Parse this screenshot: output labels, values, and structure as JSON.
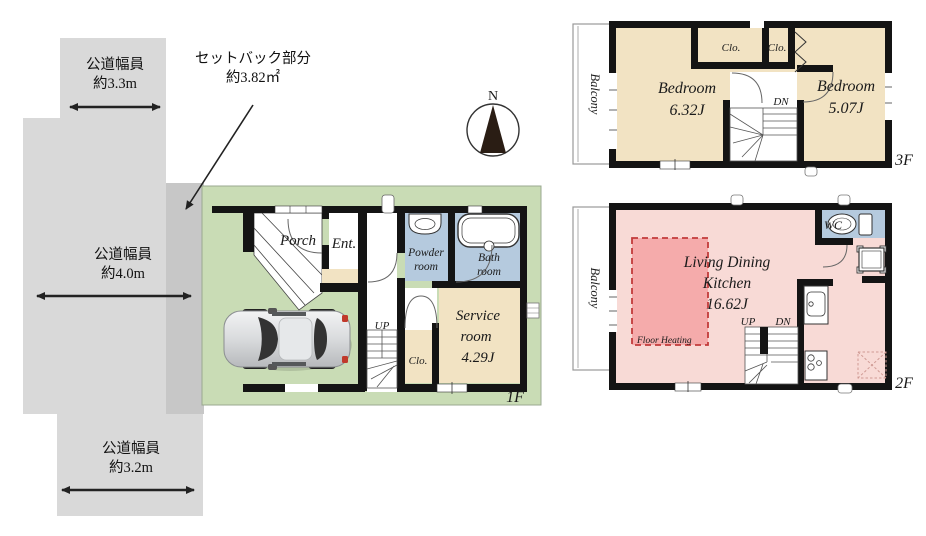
{
  "site_plan": {
    "roads": [
      {
        "label_line1": "公道幅員",
        "label_line2": "約3.3m"
      },
      {
        "label_line1": "公道幅員",
        "label_line2": "約4.0m"
      },
      {
        "label_line1": "公道幅員",
        "label_line2": "約3.2m"
      }
    ],
    "setback": {
      "label_line1": "セットバック部分",
      "label_line2": "約3.82㎡"
    }
  },
  "compass": {
    "north": "N"
  },
  "floors": {
    "f1": {
      "label": "1F",
      "porch": "Porch",
      "entrance": "Ent.",
      "powder_line1": "Powder",
      "powder_line2": "room",
      "bath_line1": "Bath",
      "bath_line2": "room",
      "service_line1": "Service",
      "service_line2": "room",
      "service_line3": "4.29J",
      "closet": "Clo.",
      "up": "UP"
    },
    "f2": {
      "label": "2F",
      "balcony": "Balcony",
      "ldk_line1": "Living Dining",
      "ldk_line2": "Kitchen",
      "ldk_line3": "16.62J",
      "floor_heating": "Floor Heating",
      "wc": "WC",
      "up": "UP",
      "dn": "DN"
    },
    "f3": {
      "label": "3F",
      "balcony": "Balcony",
      "bedroom1_line1": "Bedroom",
      "bedroom1_line2": "6.32J",
      "bedroom2_line1": "Bedroom",
      "bedroom2_line2": "5.07J",
      "closet1": "Clo.",
      "closet2": "Clo.",
      "dn": "DN"
    }
  },
  "colors": {
    "road": "#d9d9d9",
    "setback_area": "#c7c7c7",
    "lot_green": "#c9dcb5",
    "room_beige": "#f2e3c3",
    "ldk_pink": "#f8dad6",
    "floor_heating": "#f5abab",
    "heating_border": "#c23b3b",
    "wet_blue": "#b5cade",
    "wall": "#141414"
  }
}
